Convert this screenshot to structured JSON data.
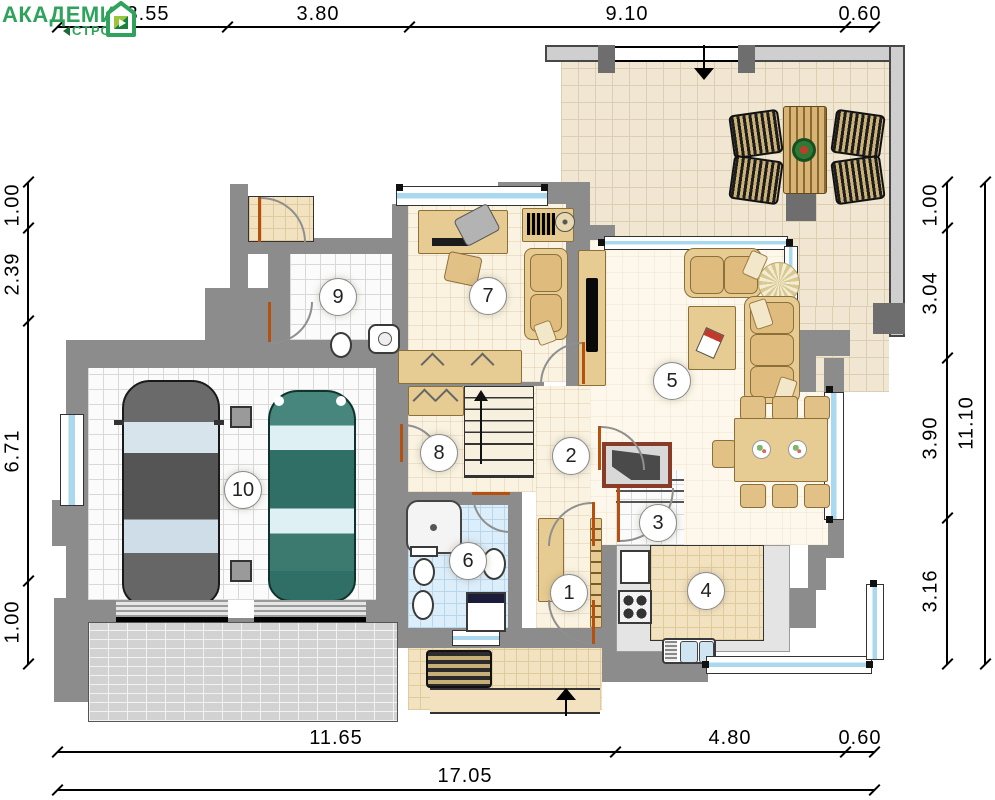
{
  "logo": {
    "title": "АКАДЕМИК",
    "subtitle": "СТРОЙ",
    "icon": "house-icon",
    "color": "#2fa35c"
  },
  "dimensions": {
    "top": [
      "3.55",
      "3.80",
      "9.10",
      "0.60"
    ],
    "bottom": [
      "11.65",
      "4.80",
      "0.60"
    ],
    "bottom_total": "17.05",
    "left": [
      "1.00",
      "2.39",
      "6.71",
      "1.00"
    ],
    "right": [
      "1.00",
      "3.04",
      "3.90",
      "3.16"
    ],
    "right_total": "11.10"
  },
  "rooms": [
    {
      "number": "1"
    },
    {
      "number": "2"
    },
    {
      "number": "3"
    },
    {
      "number": "4"
    },
    {
      "number": "5"
    },
    {
      "number": "6"
    },
    {
      "number": "7"
    },
    {
      "number": "8"
    },
    {
      "number": "9"
    },
    {
      "number": "10"
    }
  ],
  "colors": {
    "wall": "#8c8c8c",
    "window_glass": "#a9d8ef",
    "door_leaf": "#b5500f",
    "logo_green": "#2fa35c",
    "floor_cream": "#faf3e2",
    "terrace_tile": "#f0e6d1",
    "bath_tile": "#ddeefb",
    "car_dark": "#565656",
    "car_teal": "#2f6f66"
  }
}
